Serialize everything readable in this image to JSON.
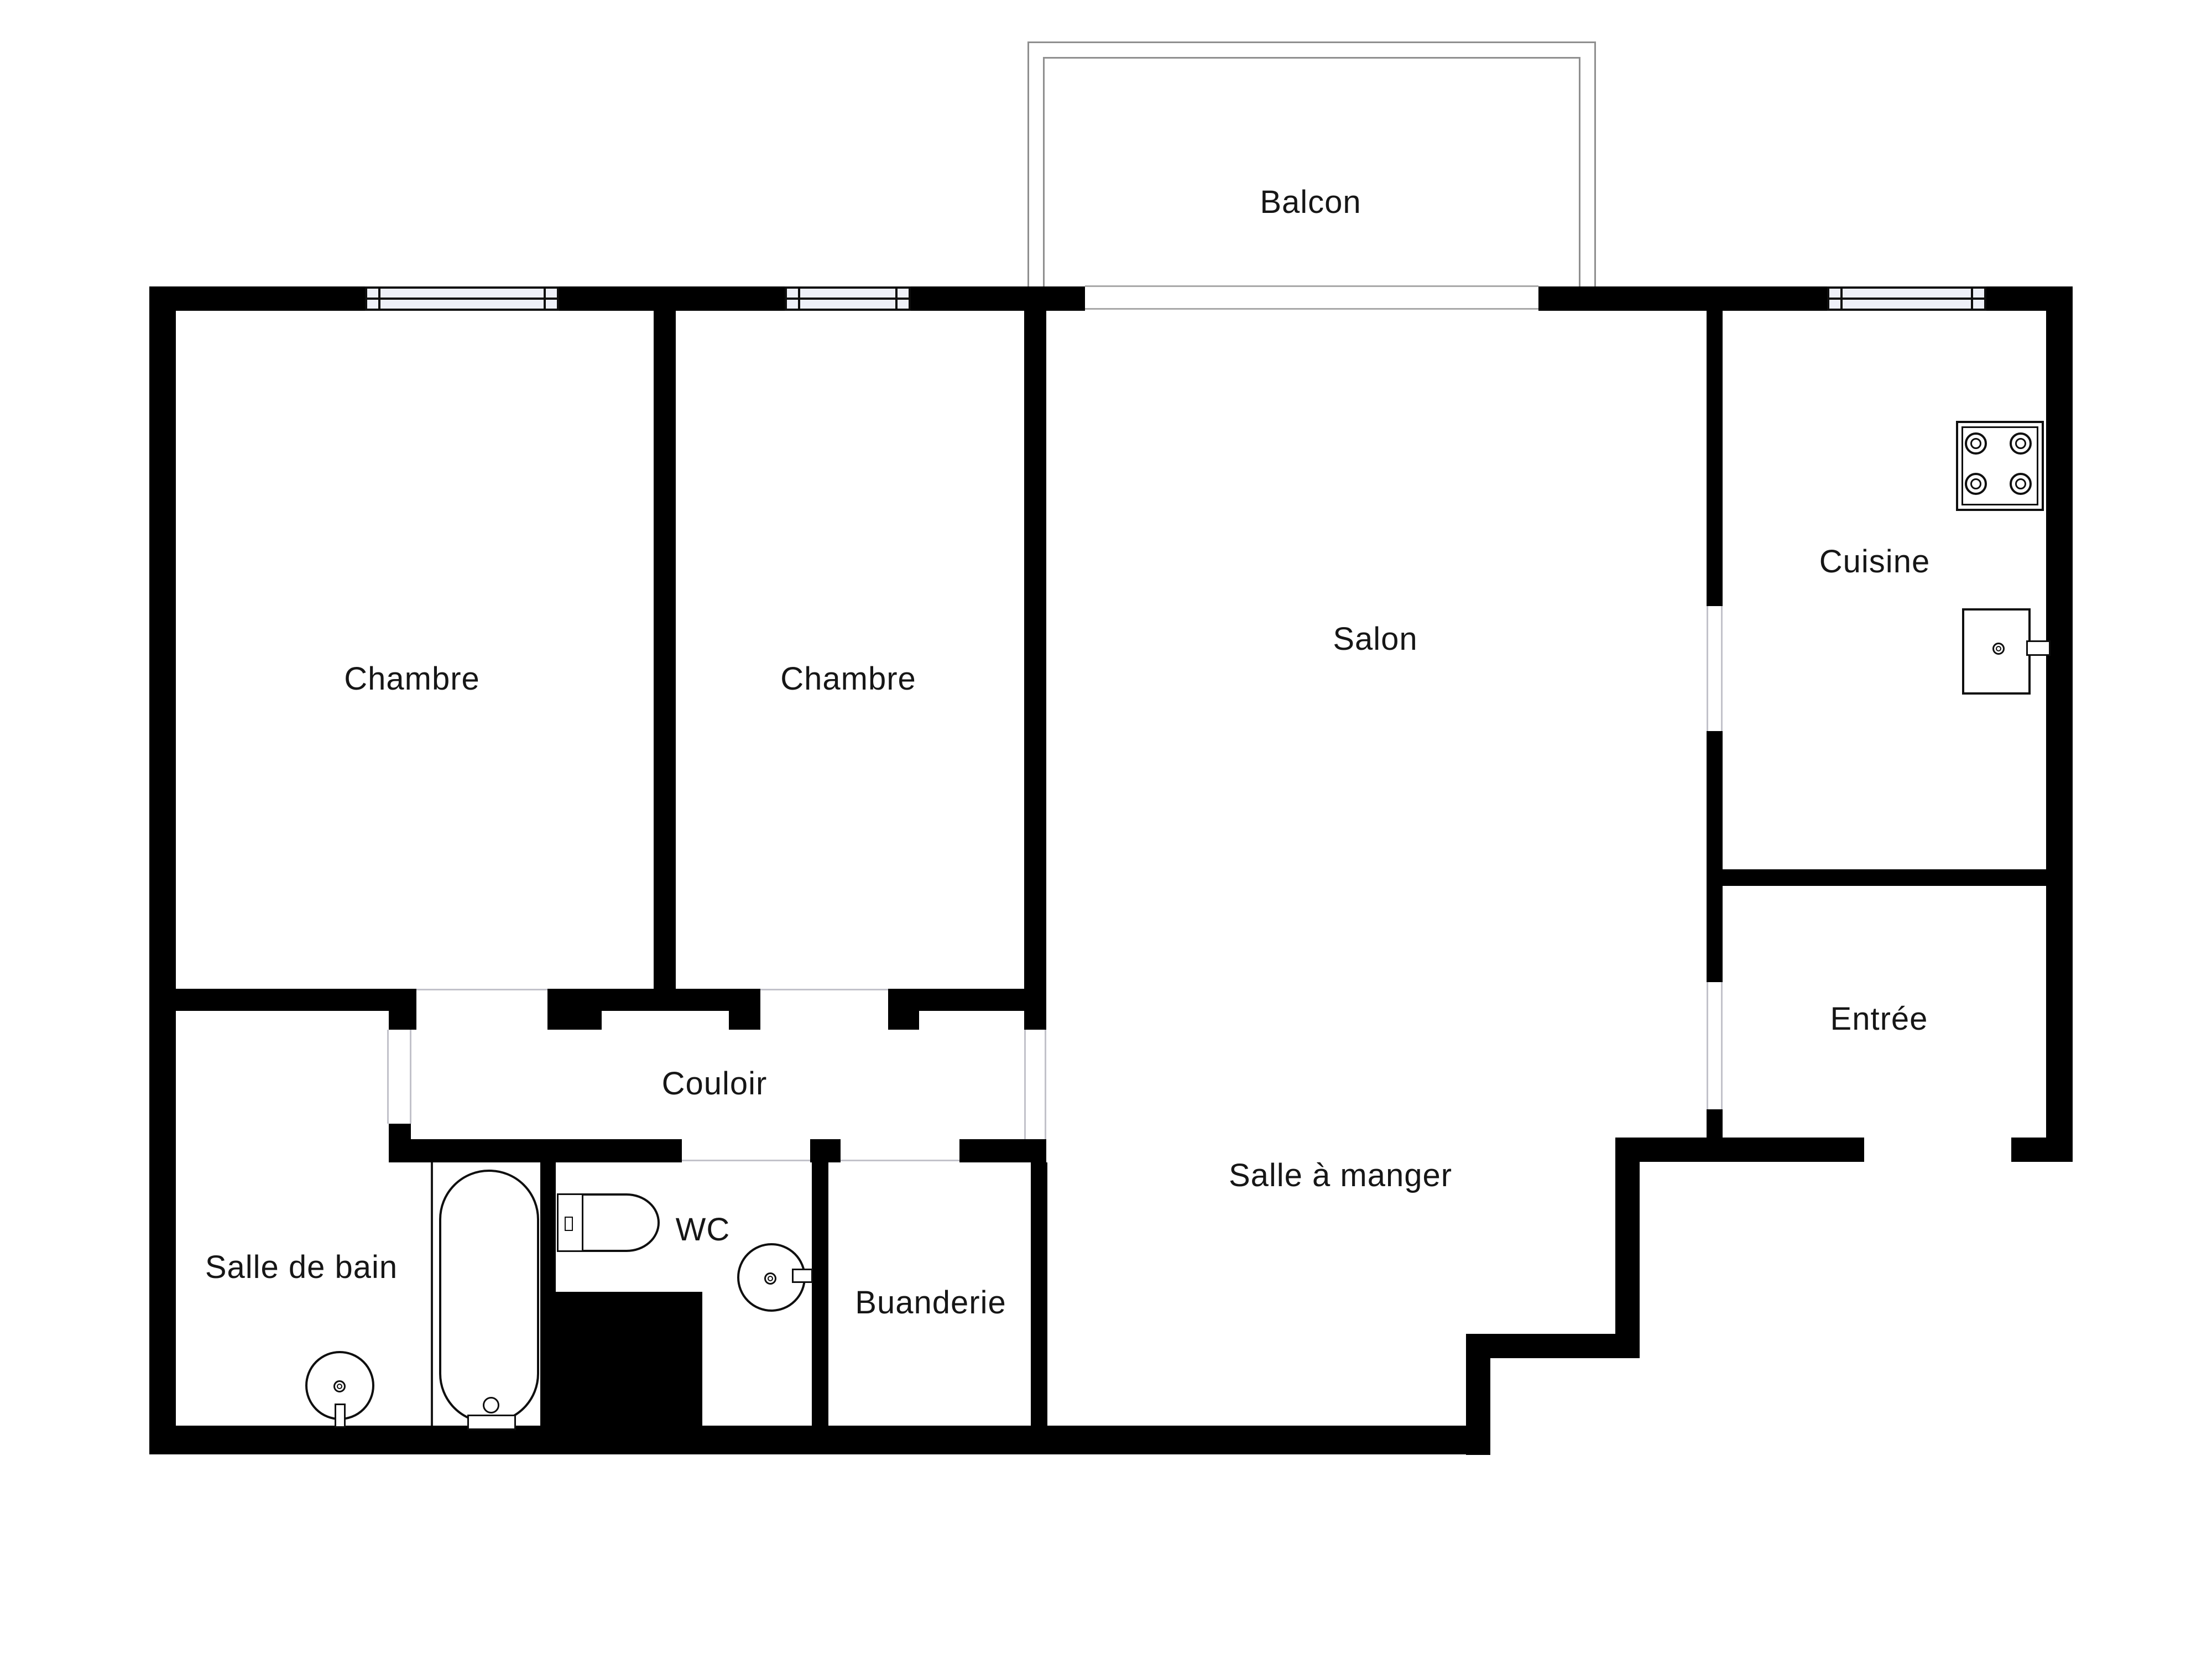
{
  "type": "floor-plan",
  "colors": {
    "wall": "#000000",
    "background": "#ffffff",
    "window_fill": "#eef0f8",
    "railing": "#8f8f8f",
    "threshold_line": "#c2c2ca",
    "text": "#161616",
    "fixture_outline": "#0f0f0f"
  },
  "rooms": {
    "balcon": {
      "label": "Balcon"
    },
    "chambre_1": {
      "label": "Chambre"
    },
    "chambre_2": {
      "label": "Chambre"
    },
    "salon": {
      "label": "Salon"
    },
    "cuisine": {
      "label": "Cuisine"
    },
    "entree": {
      "label": "Entrée"
    },
    "couloir": {
      "label": "Couloir"
    },
    "salle_a_manger": {
      "label": "Salle à manger"
    },
    "salle_de_bain": {
      "label": "Salle de bain"
    },
    "wc": {
      "label": "WC"
    },
    "buanderie": {
      "label": "Buanderie"
    }
  },
  "fixtures": [
    "balcony-railing-icon",
    "window-icon",
    "window-icon",
    "window-icon",
    "stove-icon",
    "kitchen-sink-icon",
    "bathtub-icon",
    "bathtub-faucet-icon",
    "washbasin-icon",
    "washbasin-icon",
    "toilet-icon",
    "duct-shaft-block"
  ]
}
